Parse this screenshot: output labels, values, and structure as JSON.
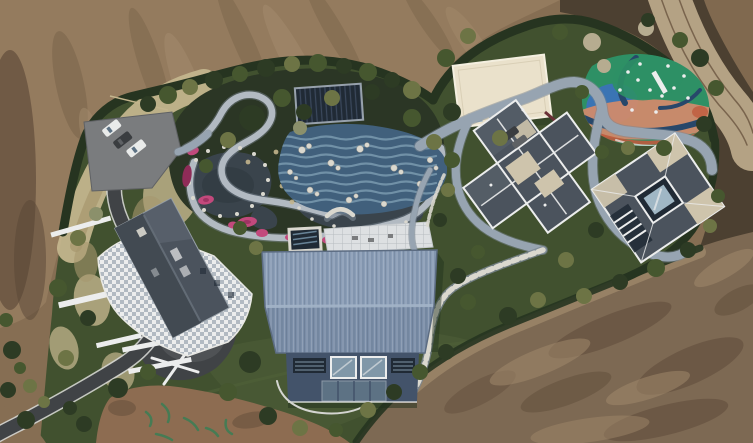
{
  "image": {
    "kind": "aerial drone photograph",
    "subject": "hillside luxury estate with landscaped water garden, five buildings, colourful playground and surrounding graded construction dirt",
    "width_px": 753,
    "height_px": 443
  },
  "regions": {
    "top_left": "bare graded brown earth",
    "top_right": "tan dirt track curving along dark rough ground",
    "bottom_right": "large cleared dirt slope with excavation streaks",
    "center": "hedge-bounded estate with ornamental pond garden, lagoon pool and stone paths",
    "bottom_left": "asphalt access road with white retaining walls and dry grass banks"
  },
  "objects": {
    "parking_cars": "three parked cars: white, dark grey, white",
    "house_left": "gabled dark-roof house with white checkered stone terrace",
    "pavilion": "dark flat-roof pavilion beside koi pond",
    "pond": "dark ornamental ponds edged with white rocks and pink azalea beds",
    "pool": "blue tiled lagoon pool with white rock islands and arched bridge",
    "spa": "small square dark plunge pool with white rim",
    "barn": "large steel-blue corrugated gable-roof hall with glass front wall",
    "villa_center": "cross-plan dark hip-roof villa with white ridge trim and beige flat decks",
    "villa_right": "square hip-roof villa with central glass courtyard and louvered wing",
    "flat_roof_building": "cream stepped flat-roof building",
    "playground": "multicoloured rubber-surface playground with white slide and play equipment",
    "paths": "winding blue-grey promenade and white stepping-stone trails",
    "road": "dark asphalt drive entering from bottom-left corner",
    "paint_marks": "green survey paint marks on bottom dirt patch"
  },
  "colors": {
    "dirtBase": "#866e53",
    "dirtLight": "#947b5e",
    "dirtPale": "#a38c6d",
    "dirtDark": "#6a5540",
    "dirtDeep": "#584535",
    "dirtRed": "#8d6c51",
    "dirtBottom": "#7d6953",
    "roadDirt": "#b4a284",
    "roadEdge": "#d4d5d1",
    "darkGround": "#4c4031",
    "hedge": "#263420",
    "treeDark": "#2d3b24",
    "treeMid": "#46572f",
    "treeOlive": "#6d7445",
    "treeGray": "#8b906b",
    "treeBare": "#b6ac90",
    "lawn": "#41512f",
    "lawnLight": "#4f5f38",
    "gardenBed": "#2b3625",
    "dryGrass": "#c3b58d",
    "dryGrassDark": "#a6976e",
    "asphalt": "#404346",
    "asphaltLight": "#5e6164",
    "parkingLot": "#7a7c7e",
    "carWhite": "#e9ebea",
    "carDark": "#3a3d40",
    "stonePath": "#b2bac2",
    "pathShadow": "#7b8793",
    "mainPath": "#97a4b1",
    "whiteTrim": "#eceded",
    "offWhite": "#dad8cf",
    "deckTile": "#dde0e2",
    "deckLine": "#b7bcc0",
    "pond": "#3a444c",
    "pondDeep": "#2f383f",
    "poolBlue": "#41607c",
    "poolLight": "#7b9ab0",
    "flowerPink": "#c2497c",
    "flowerDeep": "#8f2c58",
    "pavilion": "#202a35",
    "pavilionStripe": "#3b485c",
    "barnRoofTop": "#8a9db6",
    "barnRoofBottom": "#7b8ea8",
    "barnRidge": "#a3b4c8",
    "barnEdge": "#5c6c82",
    "barnWall": "#43536a",
    "barnWindow": "#8097a8",
    "barnGlass": "#5d7284",
    "roofDark": "#4b535d",
    "roofDark2": "#424a52",
    "roofLight": "#666f79",
    "roofBeige": "#cec4ac",
    "creamRoof": "#eae1cb",
    "creamLine": "#d9cfb6",
    "playGreen": "#2e9065",
    "playBlue": "#3a74b4",
    "playSalmon": "#d08a6c",
    "playNavy": "#27476a",
    "playRed": "#bf5a3d",
    "skyGlass": "#a0b7c5",
    "shadow": "#20301c",
    "paintGreen": "#3f7d55",
    "maroon": "#6a3036"
  }
}
